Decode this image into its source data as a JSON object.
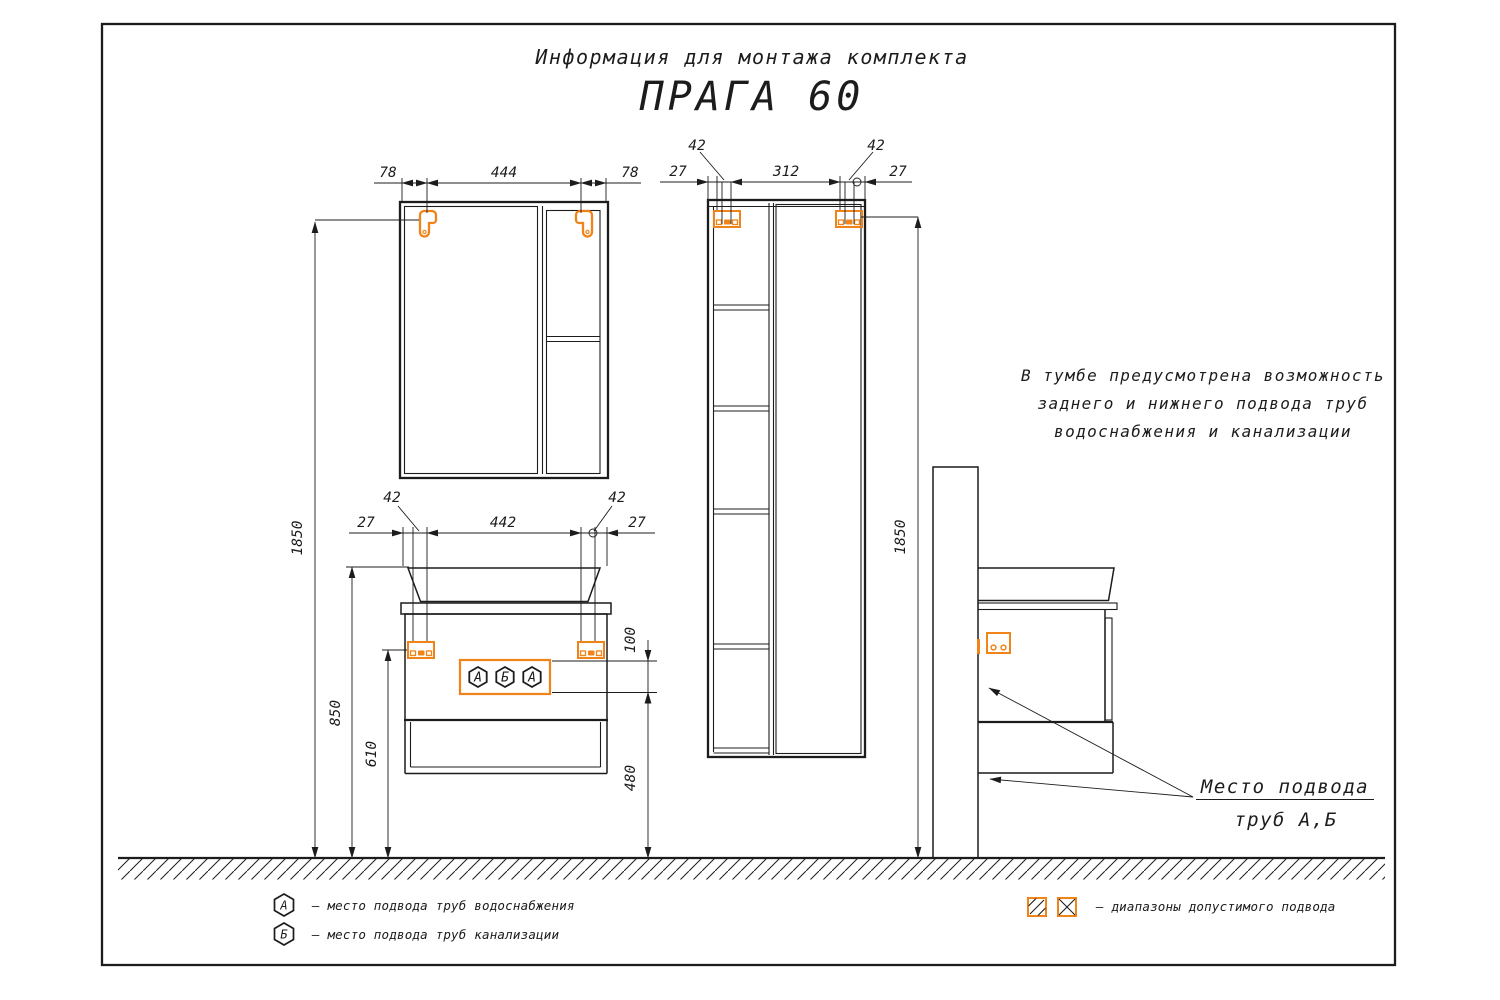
{
  "header": {
    "subtitle": "Информация для монтажа комплекта",
    "title": "ПРАГА 60"
  },
  "colors": {
    "ink": "#1c1c1c",
    "accent": "#F08418"
  },
  "mirror_view": {
    "dim_left": "78",
    "dim_width": "444",
    "dim_right": "78"
  },
  "vanity_view": {
    "dim_bracket_left": "42",
    "dim_bracket_right": "42",
    "dim_offset_left": "27",
    "dim_width": "442",
    "dim_offset_right": "27",
    "dim_zone_height": "100",
    "dim_zone_to_floor": "480",
    "dim_bracket_height": "610",
    "dim_top_height": "850",
    "port_symbols": [
      "А",
      "Б",
      "А"
    ]
  },
  "tall_view": {
    "dim_bracket_left": "42",
    "dim_bracket_right": "42",
    "dim_offset_left": "27",
    "dim_width": "312",
    "dim_offset_right": "27",
    "dim_height": "1850"
  },
  "left_height": {
    "dim_total": "1850"
  },
  "note": {
    "line1": "В тумбе предусмотрена возможность",
    "line2": "заднего и нижнего подвода труб",
    "line3": "водоснабжения и канализации"
  },
  "pipes_callout": {
    "line1": "Место подвода",
    "line2": "труб А,Б"
  },
  "legend": {
    "water_symbol": "А",
    "water_text": "–  место подвода труб водоснабжения",
    "sewer_symbol": "Б",
    "sewer_text": "–  место подвода труб канализации",
    "ranges_text": "–  диапазоны допустимого подвода"
  }
}
